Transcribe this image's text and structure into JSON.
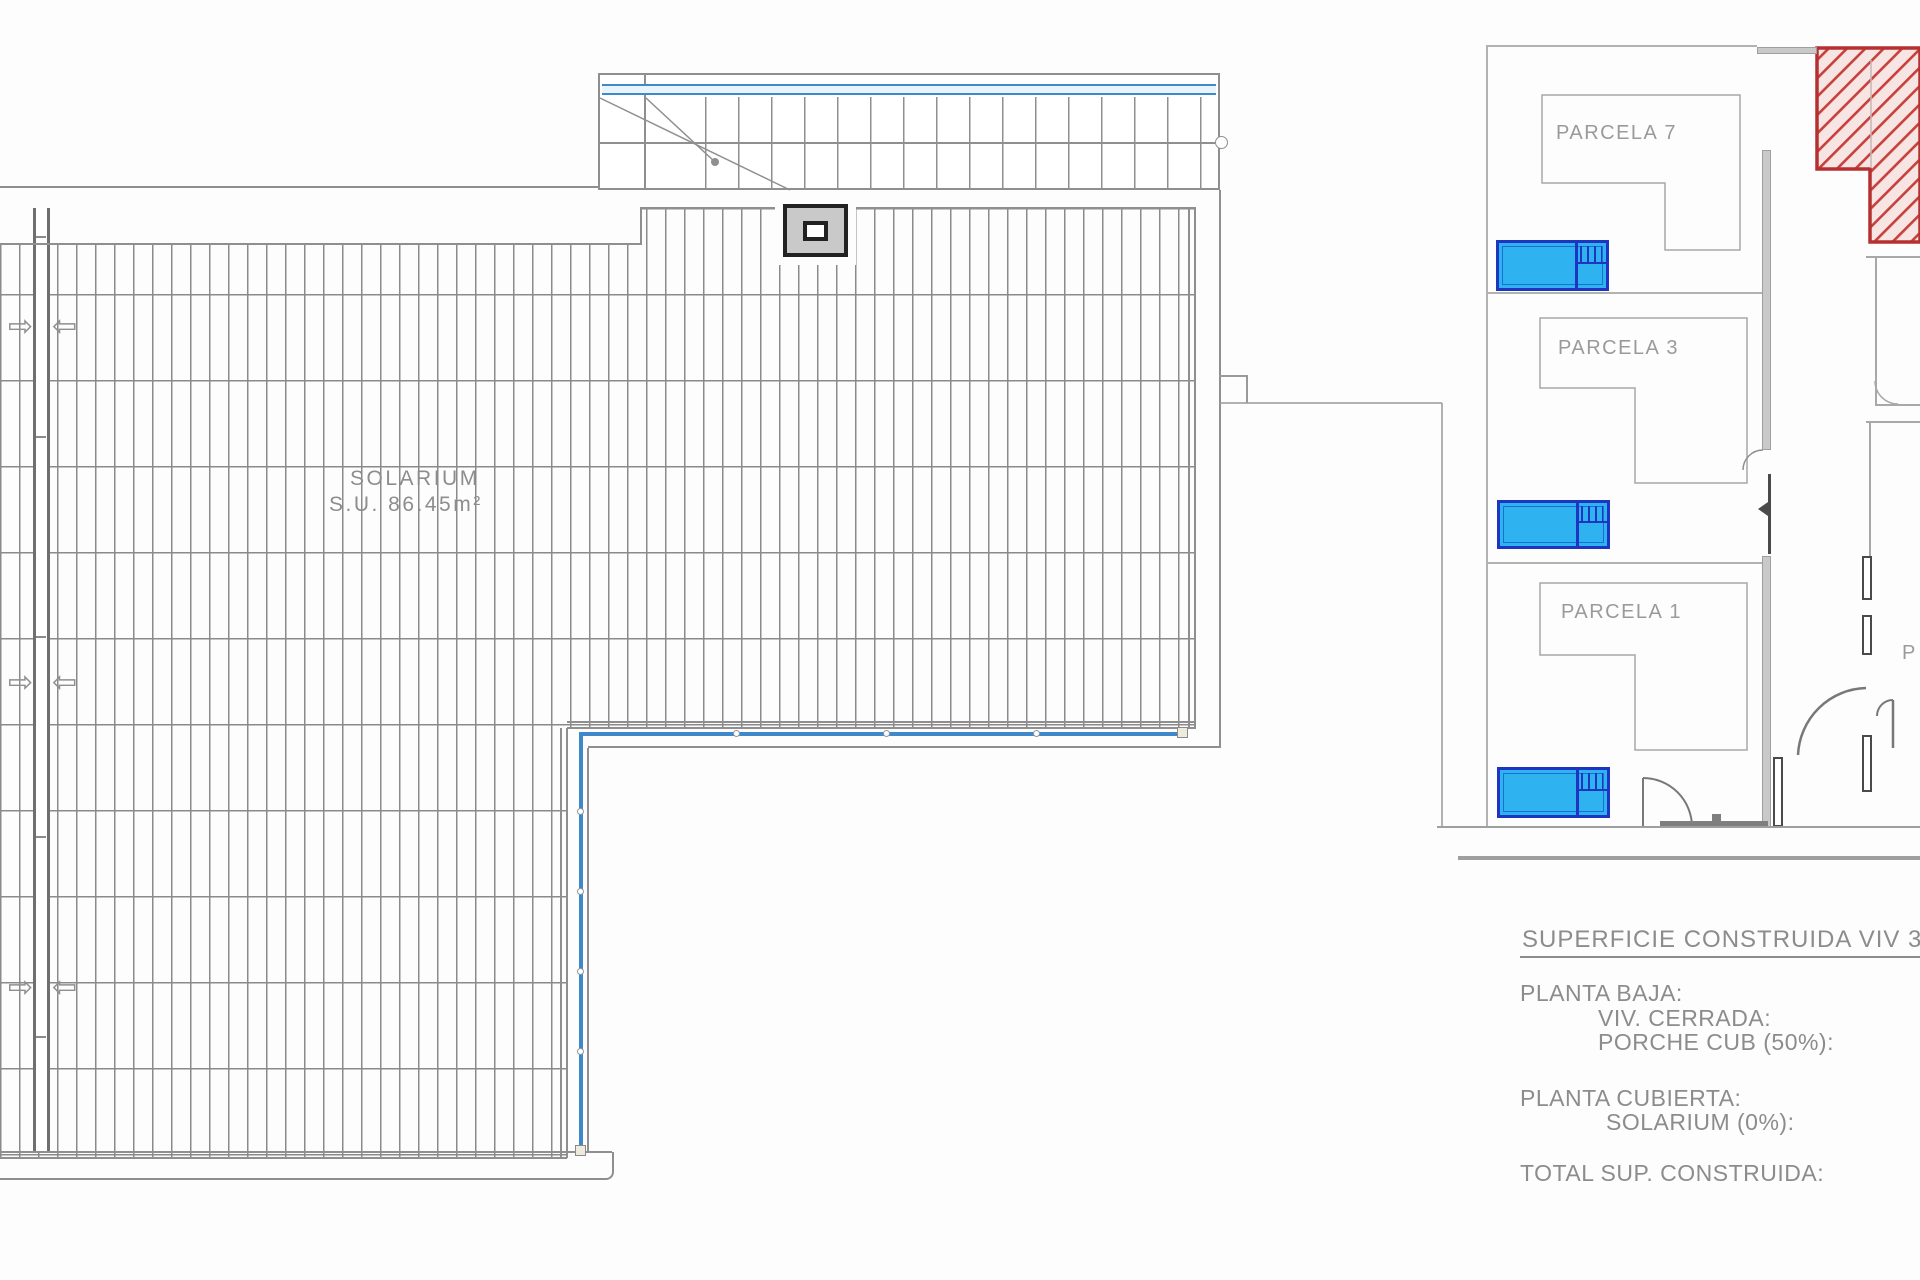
{
  "plan": {
    "solarium_line1": "SOLARIUM",
    "solarium_line2": "S.U. 86.45m²"
  },
  "site_plan": {
    "parcel_labels": [
      "PARCELA 7",
      "PARCELA 3",
      "PARCELA 1"
    ],
    "cutoff_parcel_label": "P"
  },
  "summary": {
    "heading": "SUPERFICIE CONSTRUIDA VIV 3",
    "planta_baja_label": "PLANTA BAJA:",
    "viv_cerrada_label": "VIV. CERRADA:",
    "porche_cub_label": "PORCHE CUB (50%):",
    "planta_cubierta_label": "PLANTA CUBIERTA:",
    "solarium_label": "SOLARIUM (0%):",
    "total_label": "TOTAL SUP. CONSTRUIDA:"
  },
  "icons": {
    "slope_arrow_right": "⇨",
    "slope_arrow_left": "⇦"
  },
  "colors": {
    "hatch_line": "#8a8a8a",
    "wall_gray": "#8f8f8f",
    "light_wall_gray": "#c9c9c9",
    "rail_blue": "#3f88c9",
    "pool_fill": "#2eb2f0",
    "pool_border": "#1d35c0",
    "highlight_red_border": "#b73030",
    "highlight_red_hatch": "#c8403c",
    "highlight_red_bg": "#f7e5e3",
    "text_gray": "#8c8c8c"
  }
}
